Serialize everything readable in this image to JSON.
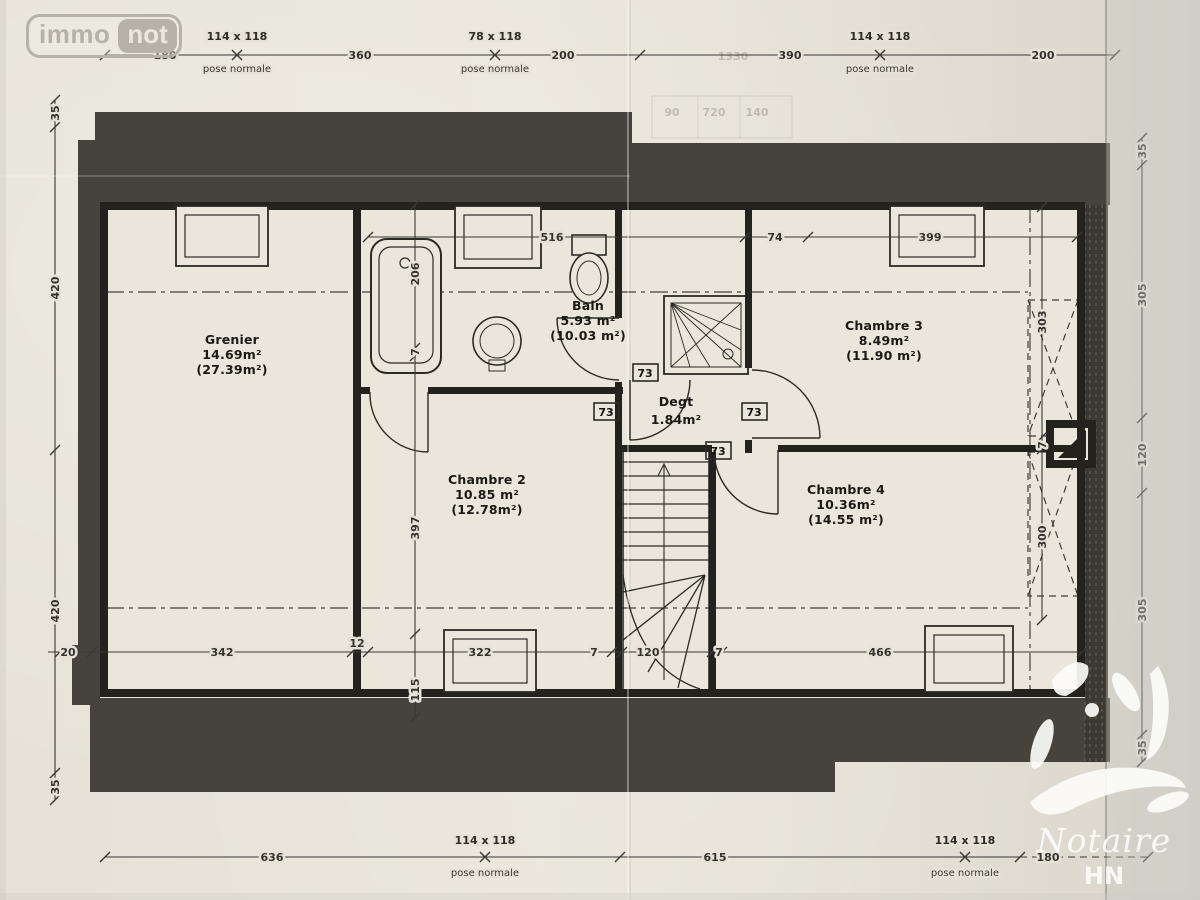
{
  "logo": {
    "part1": "immo",
    "part2": "not"
  },
  "watermark": {
    "name": "Notaire",
    "initials": "HN"
  },
  "plan": {
    "rooms": {
      "grenier": {
        "name": "Grenier",
        "area": "14.69m²",
        "floor_area": "(27.39m²)"
      },
      "bain": {
        "name": "Bain",
        "area": "5.93 m²",
        "floor_area": "(10.03 m²)"
      },
      "chambre3": {
        "name": "Chambre 3",
        "area": "8.49m²",
        "floor_area": "(11.90 m²)"
      },
      "degt": {
        "name": "Degt",
        "area": "1.84m²"
      },
      "chambre2": {
        "name": "Chambre 2",
        "area": "10.85 m²",
        "floor_area": "(12.78m²)"
      },
      "chambre4": {
        "name": "Chambre 4",
        "area": "10.36m²",
        "floor_area": "(14.55 m²)"
      }
    },
    "door_width_labels": [
      "73",
      "73",
      "73",
      "73"
    ],
    "window_tags": {
      "top": [
        {
          "size": "114 x 118",
          "pose": "pose normale"
        },
        {
          "size": "78 x 118",
          "pose": "pose normale"
        },
        {
          "size": "114 x 118",
          "pose": "pose normale"
        }
      ],
      "bottom": [
        {
          "size": "114 x 118",
          "pose": "pose normale"
        },
        {
          "size": "114 x 118",
          "pose": "pose normale"
        }
      ]
    },
    "dims": {
      "top": [
        "180",
        "360",
        "200",
        "390",
        "200"
      ],
      "left": [
        "35",
        "420",
        "420",
        "35"
      ],
      "right": [
        "35",
        "305",
        "120",
        "305",
        "35"
      ],
      "bottom": [
        "636",
        "615",
        "180"
      ],
      "inner_top": [
        "516",
        "74",
        "399"
      ],
      "inner_bottom": [
        "20",
        "342",
        "12",
        "322",
        "7",
        "120",
        "7",
        "466"
      ],
      "inner_left": [
        "206",
        "7",
        "397",
        "115"
      ],
      "inner_right": [
        "303",
        "7",
        "300"
      ]
    },
    "ghost_numbers": [
      "1330",
      "90",
      "720",
      "140"
    ]
  }
}
